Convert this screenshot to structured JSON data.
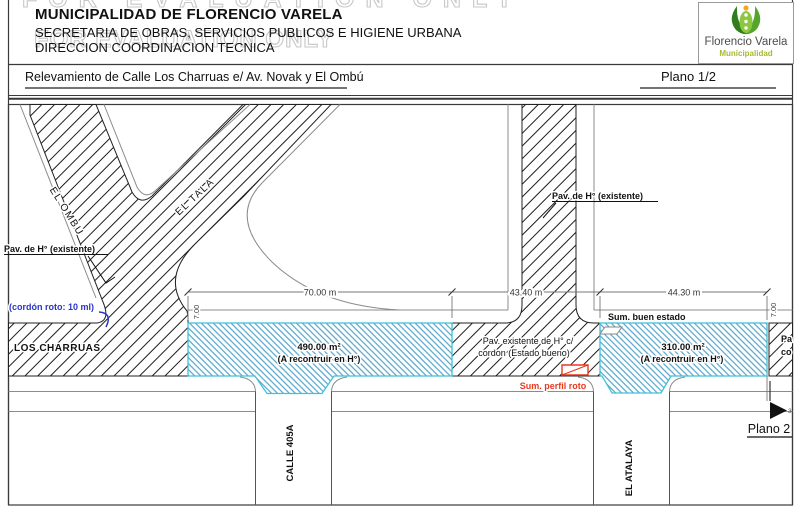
{
  "header": {
    "line1": "MUNICIPALIDAD DE FLORENCIO VARELA",
    "line2": "SECRETARIA DE OBRAS, SERVICIOS PUBLICOS E HIGIENE URBANA",
    "line3": "DIRECCION COORDINACION TECNICA",
    "watermark": "FOR EVALUATION ONLY"
  },
  "logo": {
    "title": "Florencio Varela",
    "subtitle": "Municipalidad",
    "green_dark": "#2f7d1d",
    "green_mid": "#55a52c",
    "green_light": "#8dc63f"
  },
  "titlebar": {
    "title": "Relevamiento de Calle Los Charruas e/ Av. Novak y El Ombú",
    "sheet": "Plano 1/2"
  },
  "plan": {
    "streets": {
      "el_ombu": "EL OMBU",
      "el_tala": "EL TALA",
      "los_charruas": "LOS CHARRUAS",
      "calle_405a": "CALLE 405A",
      "el_atalaya": "EL ATALAYA"
    },
    "labels": {
      "pav_left": "Pav. de H° (existente)",
      "pav_top_right": "Pav. de H° (existente)",
      "cordon_roto": "(cordón roto: 10 ml)",
      "area_west_value": "490.00 m²",
      "area_west_note": "(A recontruir en H°)",
      "pav_center_1": "Pav. existente de H° c/",
      "pav_center_2": "cordon (Estado bueno)",
      "area_east_value": "310.00 m²",
      "area_east_note": "(A recontruir en H°)",
      "sum_ok": "Sum. buen estado",
      "sum_broken": "Sum. perfil roto",
      "plano2": "Plano 2",
      "marker": "3",
      "clip_line1": "Pa",
      "clip_line2": "co"
    },
    "dims": {
      "width_west": "70.00 m",
      "width_mid": "43.40 m",
      "width_east": "44.30 m",
      "height_west": "7.00",
      "height_east": "7.00"
    },
    "colors": {
      "accent_blue": "#2a35c8",
      "accent_red": "#e8391f",
      "hatch_blue": "#4a9dc6",
      "hatch_blue_border": "#3fc1da"
    }
  }
}
